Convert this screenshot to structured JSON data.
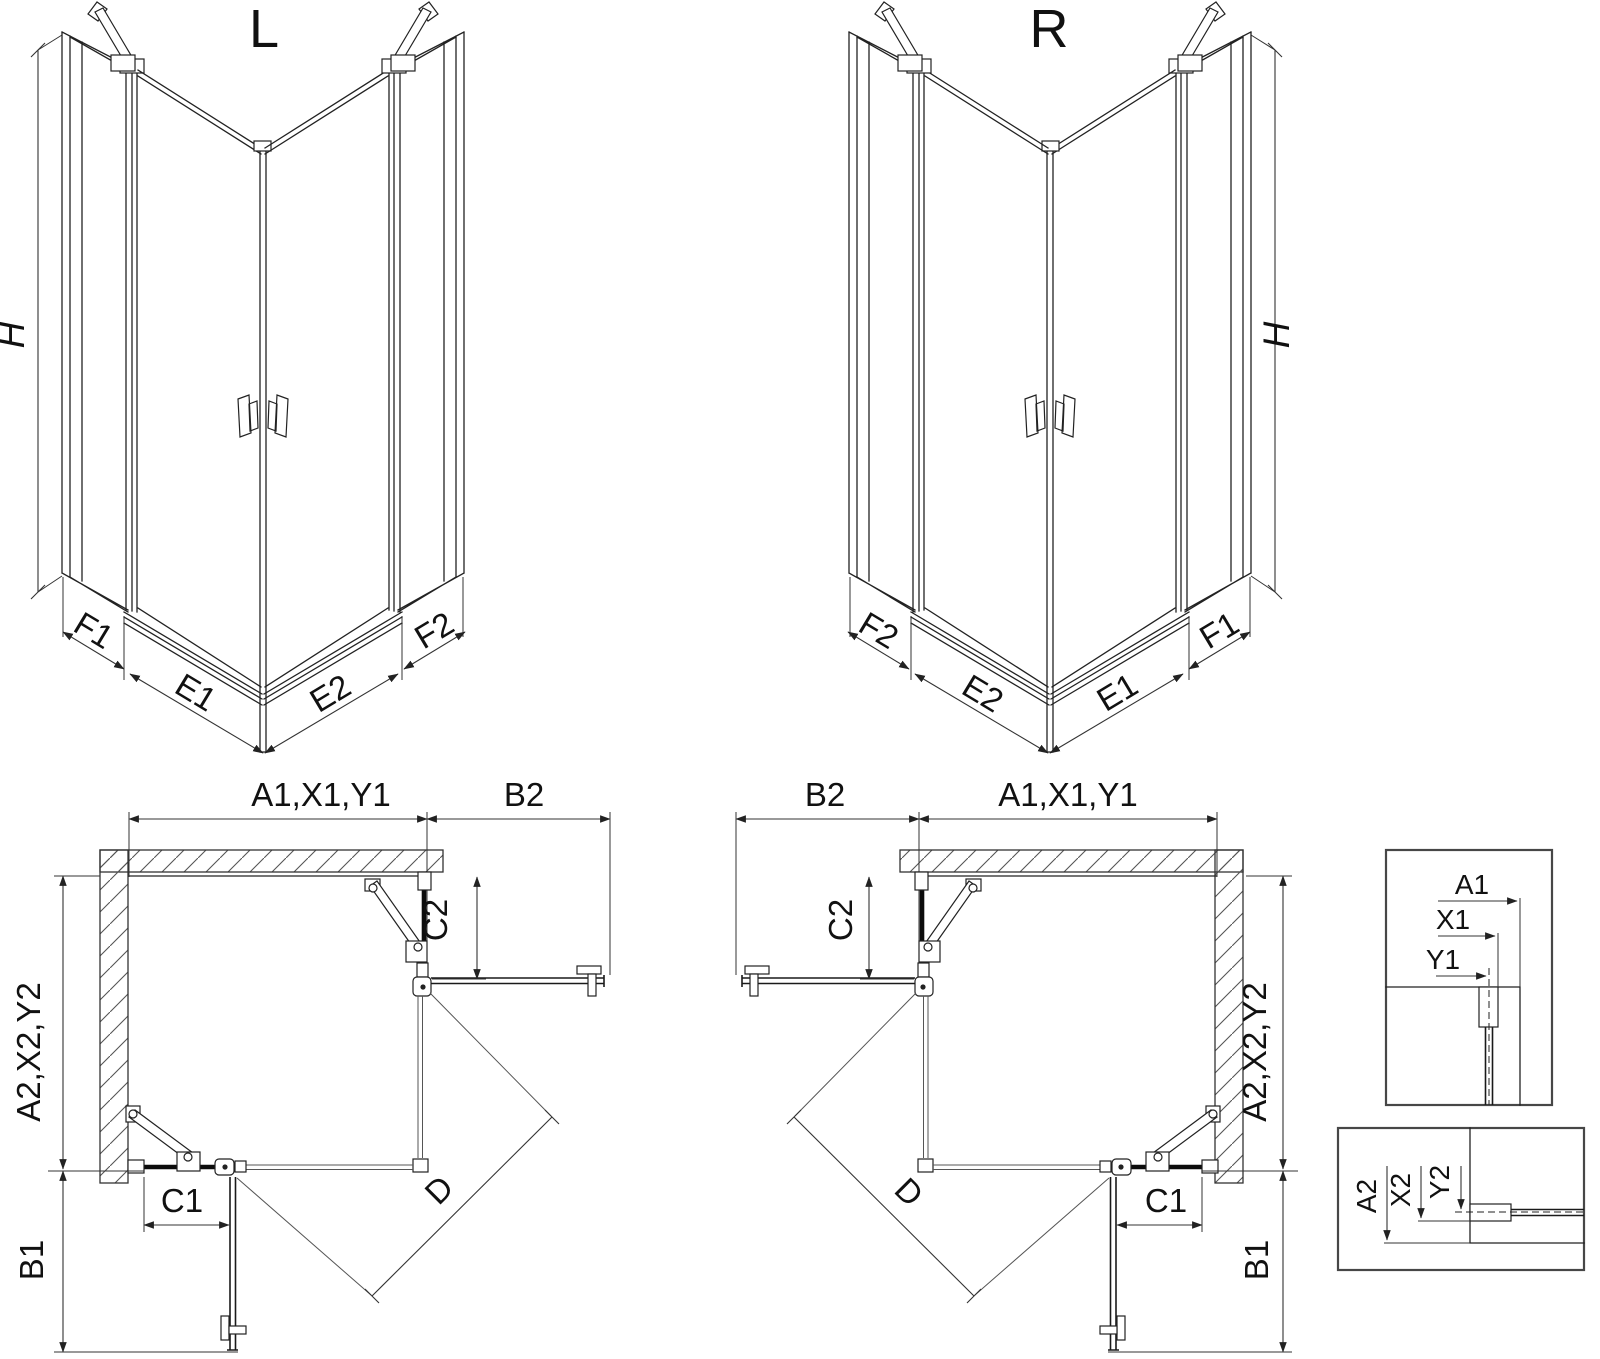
{
  "colors": {
    "background": "#ffffff",
    "line": "#222222"
  },
  "iso_left": {
    "title": "L",
    "height": "H",
    "footprint": {
      "f1": "F1",
      "e1": "E1",
      "e2": "E2",
      "f2": "F2"
    }
  },
  "iso_right": {
    "title": "R",
    "height": "H",
    "footprint": {
      "f1": "F1",
      "e1": "E1",
      "e2": "E2",
      "f2": "F2"
    }
  },
  "plan_left": {
    "width_top": "A1,X1,Y1",
    "door_top": "B2",
    "fixed_right": "C2",
    "depth_left": "A2,X2,Y2",
    "fixed_bottom": "C1",
    "door_bottom": "B1",
    "diagonal": "D"
  },
  "plan_right": {
    "width_top": "A1,X1,Y1",
    "door_top": "B2",
    "fixed_right": "C2",
    "depth_left": "A2,X2,Y2",
    "fixed_bottom": "C1",
    "door_bottom": "B1",
    "diagonal": "D"
  },
  "detail_top": {
    "a1": "A1",
    "x1": "X1",
    "y1": "Y1"
  },
  "detail_bottom": {
    "a2": "A2",
    "x2": "X2",
    "y2": "Y2"
  }
}
